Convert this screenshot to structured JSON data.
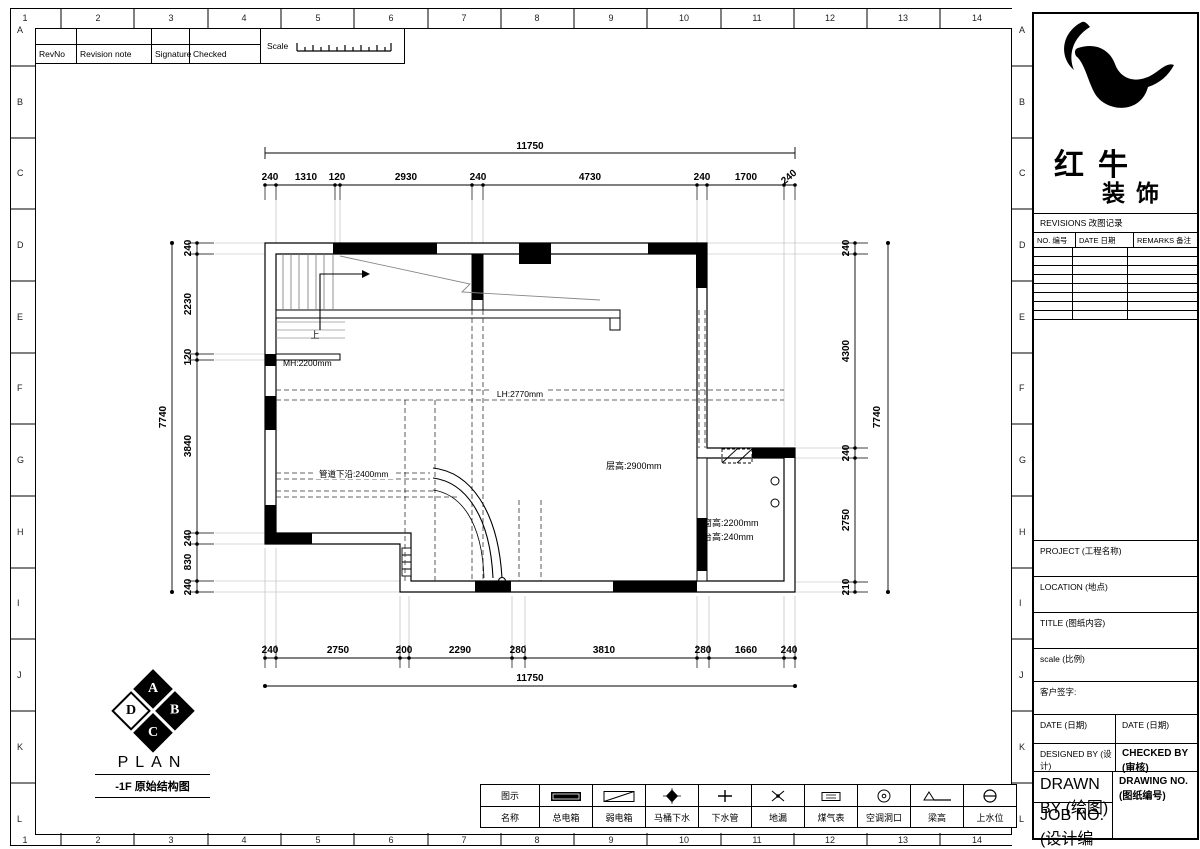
{
  "sheet": {
    "revision_strip": {
      "rev_no": "RevNo",
      "revision_note": "Revision note",
      "signature": "Signature",
      "checked": "Checked",
      "scale": "Scale"
    },
    "border": {
      "top_numbers": [
        "1",
        "2",
        "3",
        "4",
        "5",
        "6",
        "7",
        "8",
        "9",
        "10",
        "11",
        "12",
        "13",
        "14"
      ],
      "bottom_numbers": [
        "1",
        "2",
        "3",
        "4",
        "5",
        "6",
        "7",
        "8",
        "9",
        "10",
        "11",
        "12",
        "13",
        "14"
      ],
      "left_letters": [
        "A",
        "B",
        "C",
        "D",
        "E",
        "F",
        "G",
        "H",
        "I",
        "J",
        "K",
        "L"
      ],
      "right_letters": [
        "A",
        "B",
        "C",
        "D",
        "E",
        "F",
        "G",
        "H",
        "I",
        "J",
        "K",
        "L"
      ]
    }
  },
  "plan": {
    "stamp": {
      "letter_top": "A",
      "letter_right": "B",
      "letter_bottom": "C",
      "letter_left": "D",
      "title": "PLAN",
      "subtitle": "-1F 原始结构图"
    },
    "labels": {
      "mh": "MH:2200mm",
      "lh": "LH:2770mm",
      "floor_height": "层高:2900mm",
      "pipe_bottom": "管道下沿:2400mm",
      "window_height": "窗高:2200mm",
      "sill_height": "台高:240mm",
      "up": "上"
    },
    "dims": {
      "top_total": "11750",
      "top_segments": [
        "240",
        "1310",
        "120",
        "2930",
        "240",
        "4730",
        "240",
        "1700",
        "240"
      ],
      "bottom_total": "11750",
      "bottom_segments": [
        "240",
        "2750",
        "200",
        "2290",
        "280",
        "3810",
        "280",
        "1660",
        "240"
      ],
      "left_total": "7740",
      "left_segments": [
        "240",
        "2230",
        "120",
        "3840",
        "240",
        "830",
        "240"
      ],
      "right_total": "7740",
      "right_segments": [
        "240",
        "4300",
        "240",
        "2750",
        "210"
      ]
    }
  },
  "legend": {
    "header_icon": "图示",
    "header_name": "名称",
    "items": [
      {
        "icon": "main-power-box-icon",
        "label": "总电箱"
      },
      {
        "icon": "low-voltage-box-icon",
        "label": "弱电箱"
      },
      {
        "icon": "toilet-drain-icon",
        "label": "马桶下水"
      },
      {
        "icon": "drain-pipe-icon",
        "label": "下水管"
      },
      {
        "icon": "floor-drain-icon",
        "label": "地漏"
      },
      {
        "icon": "gas-meter-icon",
        "label": "煤气表"
      },
      {
        "icon": "ac-opening-icon",
        "label": "空调洞口"
      },
      {
        "icon": "beam-height-icon",
        "label": "梁高"
      },
      {
        "icon": "water-supply-icon",
        "label": "上水位"
      }
    ]
  },
  "title_block": {
    "brand_line1": "红牛",
    "brand_line2": "装饰",
    "revisions_title": "REVISIONS 改图记录",
    "col_no": "NO. 编号",
    "col_date": "DATE 日期",
    "col_remarks": "REMARKS 备注",
    "project_label": "PROJECT (工程名称)",
    "location_label": "LOCATION (地点)",
    "title_label": "TITLE (图纸内容)",
    "scale_label": "scale  (比例)",
    "client_sign_label": "客户签字:",
    "date_left_label": "DATE (日期)",
    "date_right_label": "DATE (日期)",
    "designed_by_label": "DESIGNED BY (设计)",
    "checked_by_label": "CHECKED BY (审核)",
    "drawn_by_label": "DRAWN BY (绘图)",
    "drawing_no_label": "DRAWING NO. (图纸编号)",
    "job_no_label": "JOB NO. (设计编号)"
  }
}
